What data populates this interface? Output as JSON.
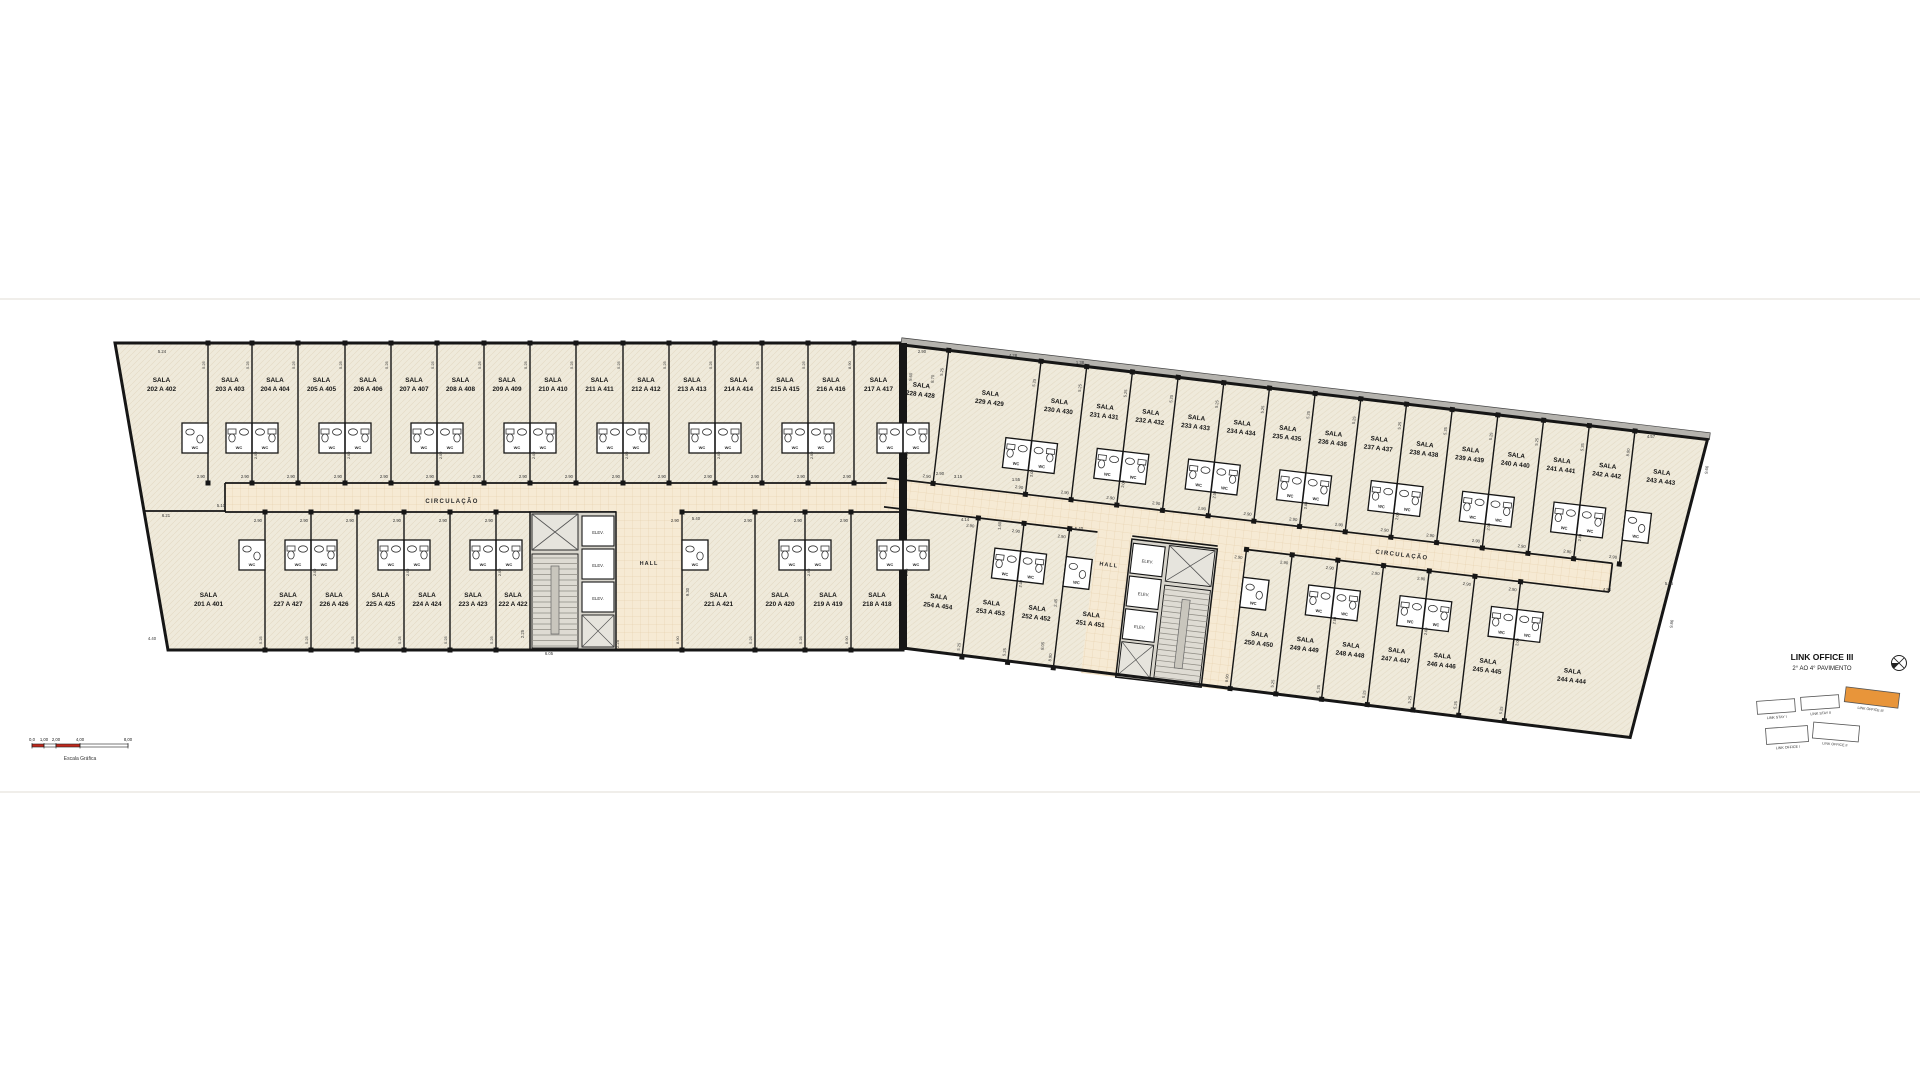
{
  "palette": {
    "room_fill": "#efeadb",
    "corridor_fill": "#f6ead4",
    "wall": "#161616",
    "core_fill": "#d8d5cc",
    "shaft_fill": "#e6e4dd",
    "stair_fill": "#dedbd3",
    "rail_fill": "#c9c6bd",
    "roof_band": "#b5b3ae",
    "accent_orange": "#e8953a",
    "scale_red": "#c0281c",
    "dim_text": "#333333",
    "sheet_line": "#ebe9e4"
  },
  "labels": {
    "room_prefix": "SALA",
    "corridor": "CIRCULAÇÃO",
    "hall": "HALL",
    "elevator": "ELEV.",
    "wc": "WC"
  },
  "title_block": {
    "line1": "LINK OFFICE III",
    "line2": "2° AO 4° PAVIMENTO",
    "key_plan": [
      {
        "label": "LINK STAY I",
        "highlight": false
      },
      {
        "label": "LINK STAY II",
        "highlight": false
      },
      {
        "label": "LINK OFFICE III",
        "highlight": true
      },
      {
        "label": "LINK OFFICE I",
        "highlight": false
      },
      {
        "label": "LINK OFFICE II",
        "highlight": false
      }
    ]
  },
  "scale_bar": {
    "ticks": [
      "0,0",
      "1,00",
      "2,00",
      "4,00",
      "8,00"
    ],
    "caption": "Escala Gráfica"
  },
  "dim_strings": {
    "corridor_width": "2.90",
    "bay": "5.25",
    "depth": "8.90",
    "wc_depth": "2.00"
  },
  "plan": {
    "left": {
      "outline": [
        [
          115,
          343
        ],
        [
          903,
          343
        ],
        [
          903,
          650
        ],
        [
          168,
          650
        ]
      ],
      "corridor": {
        "x1": 225,
        "x2": 903,
        "y1": 483,
        "y2": 512,
        "label_x": 452,
        "label_y": 503
      },
      "hall": {
        "x": 616,
        "y": 512,
        "w": 66,
        "h": 138,
        "label_x": 649,
        "label_y": 565
      },
      "core": {
        "x": 530,
        "y": 512,
        "w": 86,
        "h": 138,
        "elev_side": "right"
      },
      "left_wing_wall": [
        145,
        511,
        226,
        511
      ],
      "rows": {
        "top": {
          "y1": 343,
          "y2": 483,
          "label_y": 382,
          "wc_y": 423,
          "pairs": [
            1,
            3,
            5,
            7,
            9,
            11,
            13
          ],
          "singles": [
            {
              "i": 0,
              "side": "right"
            }
          ],
          "rooms": [
            {
              "num": "202 A 402",
              "x1": 115,
              "x2": 208
            },
            {
              "num": "203 A 403",
              "x1": 208,
              "x2": 252
            },
            {
              "num": "204 A 404",
              "x1": 252,
              "x2": 298
            },
            {
              "num": "205 A 405",
              "x1": 298,
              "x2": 345
            },
            {
              "num": "206 A 406",
              "x1": 345,
              "x2": 391
            },
            {
              "num": "207 A 407",
              "x1": 391,
              "x2": 437
            },
            {
              "num": "208 A 408",
              "x1": 437,
              "x2": 484
            },
            {
              "num": "209 A 409",
              "x1": 484,
              "x2": 530
            },
            {
              "num": "210 A 410",
              "x1": 530,
              "x2": 576
            },
            {
              "num": "211 A 411",
              "x1": 576,
              "x2": 623
            },
            {
              "num": "212 A 412",
              "x1": 623,
              "x2": 669
            },
            {
              "num": "213 A 413",
              "x1": 669,
              "x2": 715
            },
            {
              "num": "214 A 414",
              "x1": 715,
              "x2": 762
            },
            {
              "num": "215 A 415",
              "x1": 762,
              "x2": 808
            },
            {
              "num": "216 A 416",
              "x1": 808,
              "x2": 854
            },
            {
              "num": "217 A 417",
              "x1": 854,
              "x2": 903
            }
          ]
        },
        "bottom": {
          "y1": 512,
          "y2": 650,
          "label_y": 597,
          "wc_y": 540,
          "pairs": [
            1,
            3,
            5,
            8
          ],
          "singles": [
            {
              "i": 0,
              "side": "right"
            },
            {
              "i": 7,
              "side": "left"
            }
          ],
          "rooms": [
            {
              "num": "201 A 401",
              "x1": 152,
              "x2": 265
            },
            {
              "num": "227 A 427",
              "x1": 265,
              "x2": 311
            },
            {
              "num": "226 A 426",
              "x1": 311,
              "x2": 357
            },
            {
              "num": "225 A 425",
              "x1": 357,
              "x2": 404
            },
            {
              "num": "224 A 424",
              "x1": 404,
              "x2": 450
            },
            {
              "num": "223 A 423",
              "x1": 450,
              "x2": 496
            },
            {
              "num": "222 A 422",
              "x1": 496,
              "x2": 530
            },
            {
              "num": "221 A 421",
              "x1": 682,
              "x2": 755
            },
            {
              "num": "220 A 420",
              "x1": 755,
              "x2": 805
            },
            {
              "num": "219 A 419",
              "x1": 805,
              "x2": 851
            },
            {
              "num": "218 A 418",
              "x1": 851,
              "x2": 903
            }
          ]
        }
      }
    },
    "right": {
      "angle": 6.7,
      "origin": [
        903,
        345
      ],
      "outline": [
        [
          0,
          0
        ],
        [
          810,
          0
        ],
        [
          768,
          305
        ],
        [
          35,
          301
        ]
      ],
      "corridor": {
        "x1": 0,
        "x2": 730,
        "y1": 134,
        "y2": 163,
        "label_x": 520,
        "label_y": 152
      },
      "hall": {
        "x": 215,
        "y": 163,
        "w": 35,
        "h": 142,
        "strip": [
          336,
          163,
          29,
          142
        ],
        "label_x": 230,
        "label_y": 196
      },
      "core": {
        "x": 250,
        "y": 166,
        "w": 86,
        "h": 139,
        "elev_side": "left"
      },
      "rows": {
        "top": {
          "y1": 0,
          "y2": 134,
          "label_y": 40,
          "wc_y": 80,
          "pairs": [
            1,
            3,
            5,
            7,
            9,
            11,
            13
          ],
          "singles": [
            {
              "i": 15,
              "side": "left"
            }
          ],
          "rooms": [
            {
              "num": "228 A 428",
              "x1": 0,
              "x2": 46
            },
            {
              "num": "229 A 429",
              "x1": 46,
              "x2": 139
            },
            {
              "num": "230 A 430",
              "x1": 139,
              "x2": 185
            },
            {
              "num": "231 A 431",
              "x1": 185,
              "x2": 231
            },
            {
              "num": "232 A 432",
              "x1": 231,
              "x2": 277
            },
            {
              "num": "233 A 433",
              "x1": 277,
              "x2": 323
            },
            {
              "num": "234 A 434",
              "x1": 323,
              "x2": 369
            },
            {
              "num": "235 A 435",
              "x1": 369,
              "x2": 415
            },
            {
              "num": "236 A 436",
              "x1": 415,
              "x2": 461
            },
            {
              "num": "237 A 437",
              "x1": 461,
              "x2": 507
            },
            {
              "num": "238 A 438",
              "x1": 507,
              "x2": 553
            },
            {
              "num": "239 A 439",
              "x1": 553,
              "x2": 599
            },
            {
              "num": "240 A 440",
              "x1": 599,
              "x2": 645
            },
            {
              "num": "241 A 441",
              "x1": 645,
              "x2": 691
            },
            {
              "num": "242 A 442",
              "x1": 691,
              "x2": 737
            },
            {
              "num": "243 A 443",
              "x1": 737,
              "x2": 800
            }
          ]
        },
        "bottom": {
          "y1": 163,
          "y2": 303,
          "label_y": 248,
          "wc_y": 191,
          "pairs": [
            1,
            5,
            7,
            9
          ],
          "singles": [
            {
              "i": 3,
              "side": "left"
            },
            {
              "i": 4,
              "side": "left"
            }
          ],
          "rooms": [
            {
              "num": "254 A 454",
              "x1": 35,
              "x2": 95
            },
            {
              "num": "253 A 453",
              "x1": 95,
              "x2": 141
            },
            {
              "num": "252 A 452",
              "x1": 141,
              "x2": 187
            },
            {
              "num": "251 A 451",
              "x1": 187,
              "x2": 250
            },
            {
              "num": "250 A 450",
              "x1": 365,
              "x2": 411
            },
            {
              "num": "249 A 449",
              "x1": 411,
              "x2": 457
            },
            {
              "num": "248 A 448",
              "x1": 457,
              "x2": 503
            },
            {
              "num": "247 A 447",
              "x1": 503,
              "x2": 549
            },
            {
              "num": "246 A 446",
              "x1": 549,
              "x2": 595
            },
            {
              "num": "245 A 445",
              "x1": 595,
              "x2": 641
            },
            {
              "num": "244 A 444",
              "x1": 641,
              "x2": 765
            }
          ]
        }
      }
    },
    "party_wall": {
      "x": 899,
      "y": 343,
      "w": 8,
      "h": 307
    },
    "party_wc": [
      {
        "cx": 903,
        "y": 423
      },
      {
        "cx": 903,
        "y": 540
      }
    ],
    "loose_dims": [
      {
        "t": "5.24",
        "x": 162,
        "y": 353
      },
      {
        "t": "6.21",
        "x": 166,
        "y": 517
      },
      {
        "t": "5.10",
        "x": 221,
        "y": 507
      },
      {
        "t": "4.40",
        "x": 152,
        "y": 640
      },
      {
        "t": "6.05",
        "x": 549,
        "y": 655
      },
      {
        "t": "2.25",
        "x": 524,
        "y": 634,
        "r": -90
      },
      {
        "t": "9.30",
        "x": 689,
        "y": 592,
        "r": -90
      },
      {
        "t": "5.40",
        "x": 696,
        "y": 520
      },
      {
        "t": "2.90",
        "x": 922,
        "y": 353
      },
      {
        "t": "9.60",
        "x": 912,
        "y": 377,
        "r": -84
      },
      {
        "t": "8.70",
        "x": 934,
        "y": 379,
        "r": -84
      },
      {
        "t": "4.28",
        "x": 1013,
        "y": 357
      },
      {
        "t": "1.38",
        "x": 1080,
        "y": 364
      },
      {
        "t": "3.15",
        "x": 958,
        "y": 478
      },
      {
        "t": "1.55",
        "x": 1016,
        "y": 481
      },
      {
        "t": "4.14",
        "x": 965,
        "y": 521
      },
      {
        "t": "1.60",
        "x": 1001,
        "y": 526,
        "r": -84
      },
      {
        "t": "5.40",
        "x": 1079,
        "y": 530
      },
      {
        "t": "4.57",
        "x": 1651,
        "y": 438
      },
      {
        "t": "9.66",
        "x": 1708,
        "y": 470,
        "r": -83
      },
      {
        "t": "5.36",
        "x": 1669,
        "y": 585
      },
      {
        "t": "4.94",
        "x": 1607,
        "y": 591
      },
      {
        "t": "9.86",
        "x": 1673,
        "y": 624,
        "r": -83
      },
      {
        "t": "2.45",
        "x": 1057,
        "y": 603,
        "r": -84
      },
      {
        "t": "8.05",
        "x": 1044,
        "y": 646,
        "r": -84
      },
      {
        "t": "2.25",
        "x": 619,
        "y": 644,
        "r": -90
      },
      {
        "t": "2.90",
        "x": 940,
        "y": 475
      }
    ]
  }
}
